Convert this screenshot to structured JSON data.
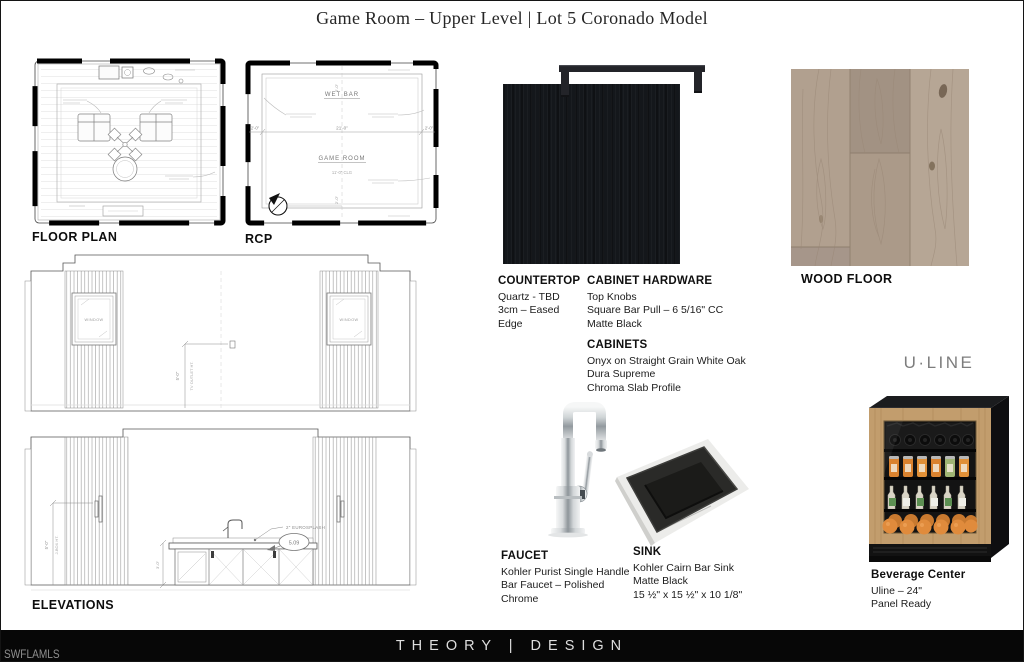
{
  "title": "Game Room – Upper Level | Lot 5 Coronado Model",
  "labels": {
    "floor_plan": "FLOOR PLAN",
    "rcp": "RCP",
    "elevations": "ELEVATIONS",
    "wood_floor": "WOOD FLOOR"
  },
  "rcp_drawing": {
    "wet_bar": "WET BAR",
    "game_room": "GAME ROOM",
    "clg_note": "11'-0\" CLG",
    "dim_center": "21'-0\"",
    "dim_left": "2'-0\"",
    "dim_right": "2'-0\"",
    "dim_soffit_top": "2'-0\"",
    "dim_soffit_bottom": "2'-0\""
  },
  "elevation_drawing": {
    "window_left": "WINDOW",
    "window_right": "WINDOW",
    "tv_dim": "5'-0\"",
    "tv_note": "TV OUTLET HT.",
    "jbox_dim": "5'-0\"",
    "jbox_note": "J-BOX HT.",
    "cab_dim": "3'-0\"",
    "eurosplash_note": "2\" EUROSPLASH",
    "tag": "5.09"
  },
  "specs": {
    "countertop": {
      "heading": "COUNTERTOP",
      "lines": [
        "Quartz - TBD",
        "3cm – Eased Edge"
      ]
    },
    "cabinet_hardware": {
      "heading": "CABINET HARDWARE",
      "lines": [
        "Top Knobs",
        "Square Bar Pull – 6 5/16\" CC",
        "Matte Black"
      ]
    },
    "cabinets": {
      "heading": "CABINETS",
      "lines": [
        "Onyx on Straight Grain White Oak",
        "Dura Supreme",
        "Chroma Slab Profile"
      ]
    },
    "faucet": {
      "heading": "FAUCET",
      "lines": [
        "Kohler Purist Single Handle",
        "Bar Faucet – Polished Chrome"
      ]
    },
    "sink": {
      "heading": "SINK",
      "lines": [
        "Kohler Cairn Bar Sink",
        "Matte Black",
        "15 ½\" x 15 ½\" x 10 1/8\""
      ]
    },
    "beverage_center": {
      "brand": "U·LINE",
      "heading": "Beverage Center",
      "lines": [
        "Uline – 24\"",
        "Panel Ready"
      ]
    }
  },
  "footer": {
    "brand": "THEORY | DESIGN",
    "watermark": "SWFLAMLS"
  },
  "colors": {
    "countertop_black": "#14171b",
    "hardware_black": "#232429",
    "wood_floor_tan": "#b1a08f",
    "cabinet_oak": "#c29d6d",
    "footer_black": "#070707",
    "uline_gray": "#7d7d7d"
  }
}
